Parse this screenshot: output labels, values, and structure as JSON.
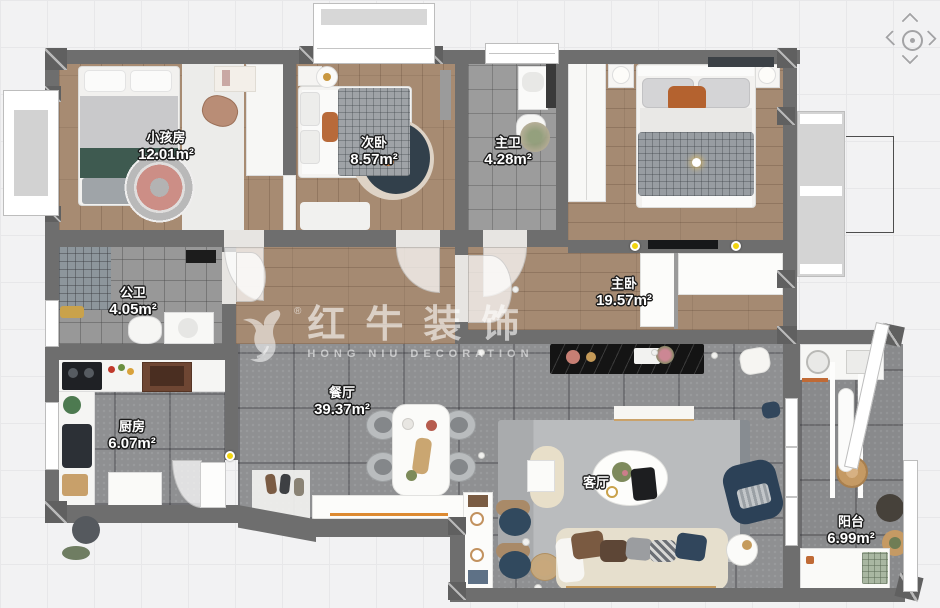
{
  "app": {
    "name": "floor-plan-canvas"
  },
  "pan_control": {
    "up": "chevron-up-icon",
    "down": "chevron-down-icon",
    "left": "chevron-left-icon",
    "right": "chevron-right-icon",
    "center": "pan-center-icon"
  },
  "watermark": {
    "registered": "®",
    "title": "红牛装饰",
    "subtitle": "HONG NIU DECORATION"
  },
  "rooms": [
    {
      "name": "小孩房",
      "area": "12.01m²"
    },
    {
      "name": "次卧",
      "area": "8.57m²"
    },
    {
      "name": "主卫",
      "area": "4.28m²"
    },
    {
      "name": "主卧",
      "area": "19.57m²"
    },
    {
      "name": "公卫",
      "area": "4.05m²"
    },
    {
      "name": "厨房",
      "area": "6.07m²"
    },
    {
      "name": "餐厅",
      "area": "39.37m²"
    },
    {
      "name": "客厅",
      "area": ""
    },
    {
      "name": "阳台",
      "area": "6.99m²"
    }
  ],
  "colors": {
    "wall": "#6e6e6e",
    "background": "#f2f2f3",
    "wood_floor": "#a78b72",
    "dark_tile": "#8f9092",
    "bath_tile": "#9c9c9c",
    "accent_orange": "#dd8a31",
    "spotlight_marker": "#f2d50f",
    "label_text": "#ffffff"
  }
}
